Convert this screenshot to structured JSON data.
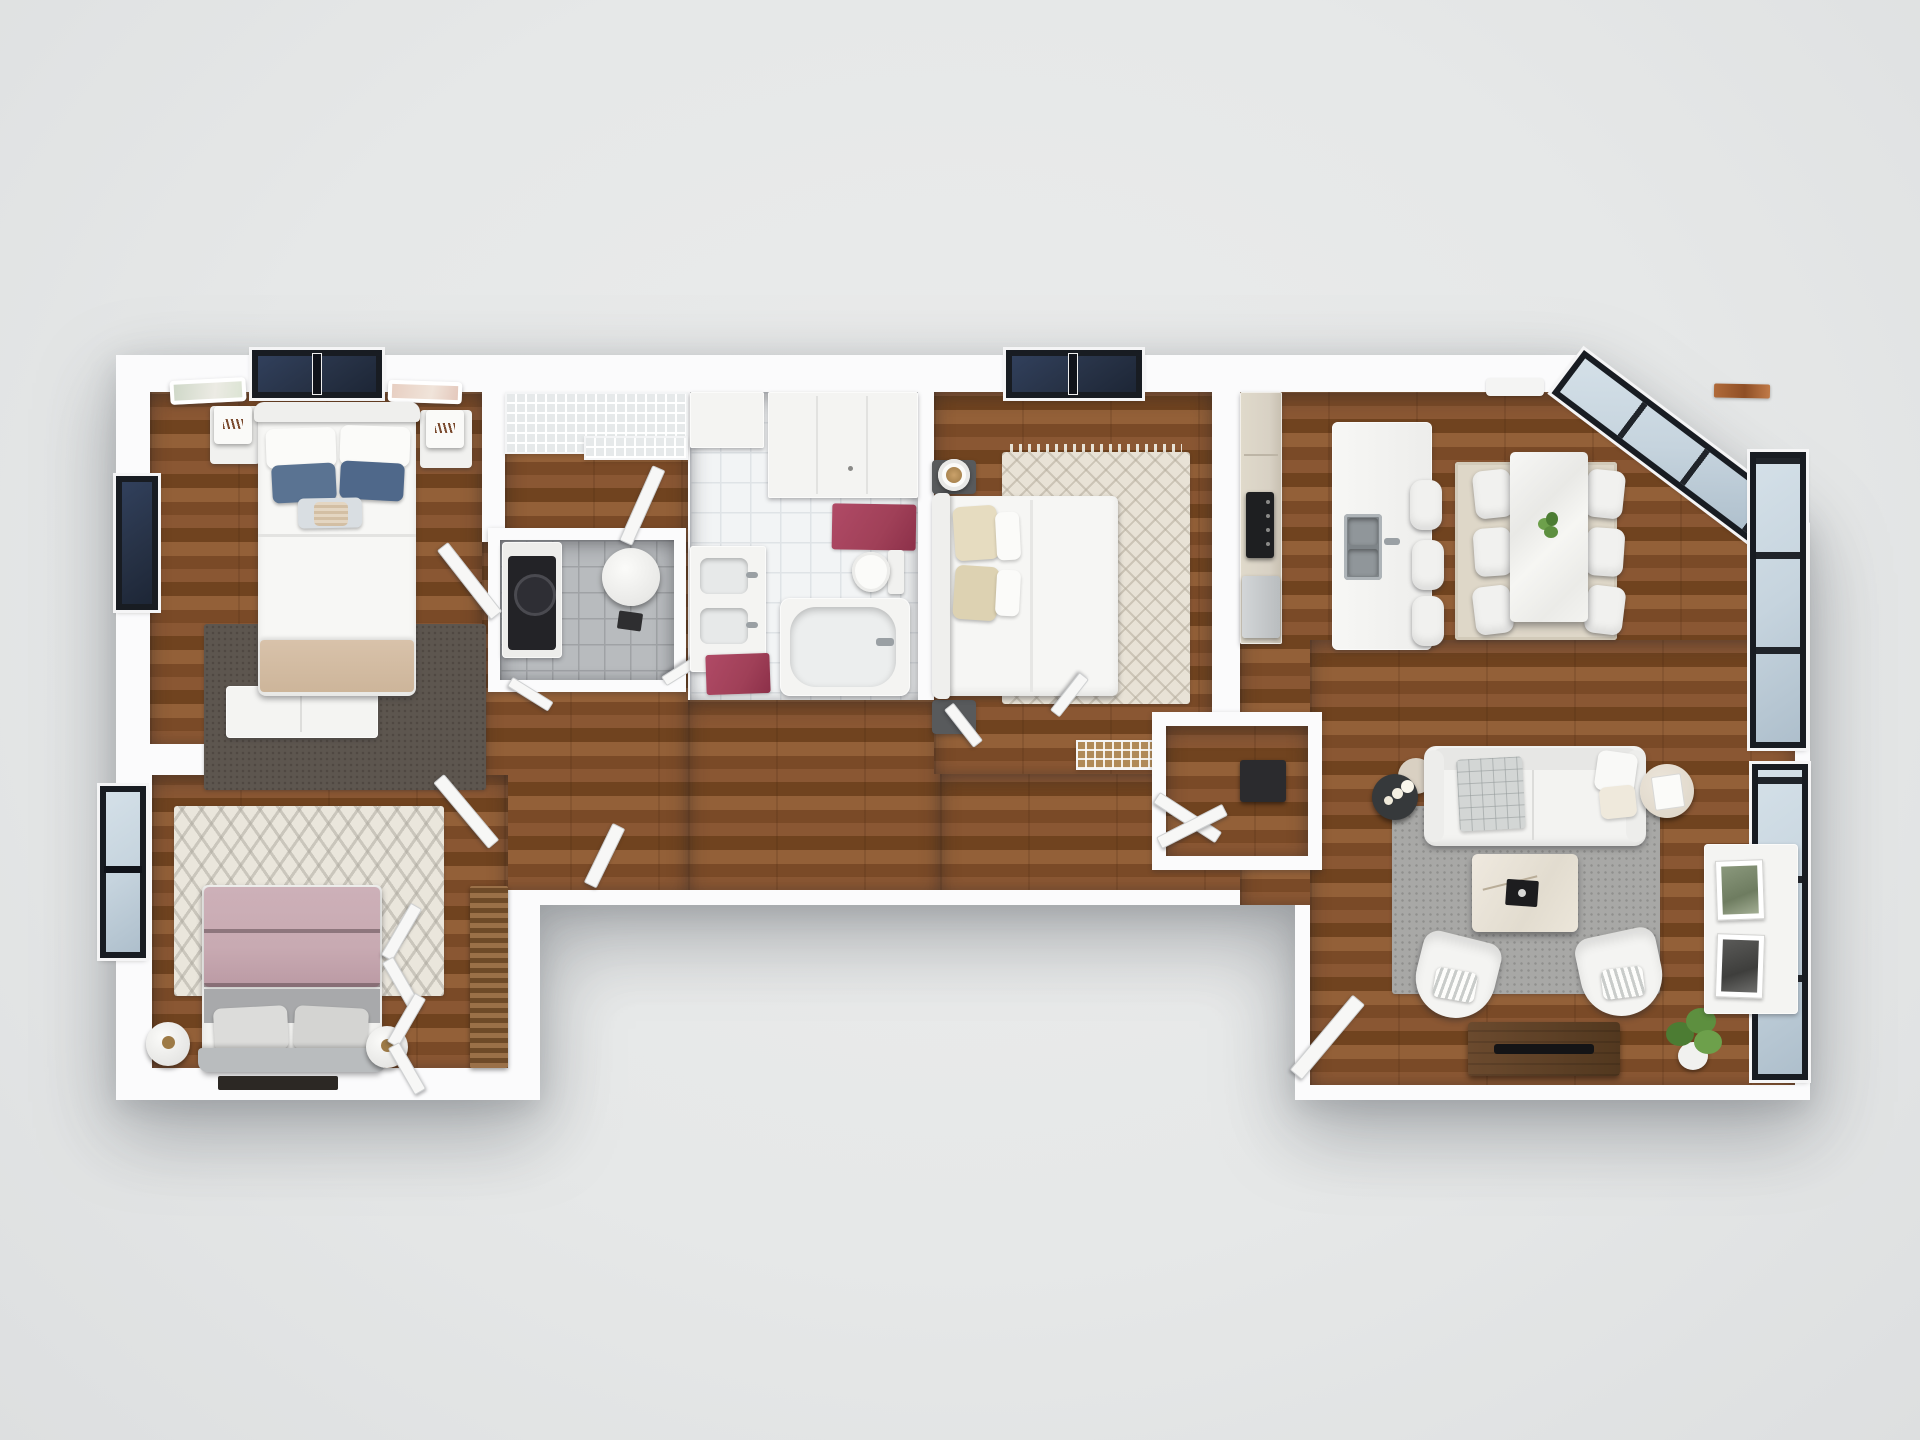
{
  "scene": {
    "kind": "3d-floor-plan-render",
    "view": "top-down",
    "unit": "3-bedroom apartment",
    "visible_text": "none"
  },
  "palette": {
    "bg1": "#ebecec",
    "bg2": "#dddfe0",
    "wall": "#fbfbfc",
    "navy": "#273246",
    "frame": "#181c22",
    "glass": "#c6d4de",
    "maroon": "#a04058",
    "white-f": "#f4f4f2",
    "white-f2": "#ececea",
    "slateblue": "#5a7392",
    "tan": "#d8c2aa",
    "mauve": "#c8aab2",
    "grayduvet": "#a8a9ab",
    "cream": "#e6dcc0",
    "beigerug": "#ded7c8",
    "grayrug": "#a8a8a6",
    "cab": "#d8d1c4",
    "steel": "#9aa0a4",
    "darkwood": "#52381f",
    "plant": "#5d8f3f"
  },
  "rooms": {
    "bedroom_primary": {
      "name": "Primary bedroom (top-left)",
      "floor": "wood",
      "items": [
        "double bed with blue and white pillows",
        "tan foot blanket",
        "two nightstands with lamps",
        "dark textured area rug",
        "white low dresser",
        "two wall art frames",
        "navy top window",
        "navy left window"
      ]
    },
    "walk_in_closet": {
      "name": "Walk-in closet",
      "floor": "wood",
      "items": [
        "white wire shelving"
      ]
    },
    "utility_room": {
      "name": "Utility room",
      "floor": "gray tile",
      "items": [
        "washer with dark door",
        "round water heater",
        "waste bin",
        "double swing doors"
      ]
    },
    "bathroom": {
      "name": "Bathroom",
      "floor": "white tile",
      "items": [
        "tall storage cabinet",
        "vanity with two sinks",
        "toilet",
        "bathtub",
        "two maroon rugs"
      ]
    },
    "bedroom_middle": {
      "name": "Middle bedroom",
      "floor": "wood",
      "items": [
        "bed with cream pillows",
        "diamond-pattern rug with tassels",
        "two dark nightstands",
        "decor plate",
        "wire storage bench",
        "navy top window"
      ]
    },
    "kitchen": {
      "name": "Kitchen",
      "floor": "wood",
      "items": [
        "tall beige cabinets",
        "black cooktop",
        "fridge",
        "island with double steel sink",
        "three bar stools"
      ]
    },
    "dining_area": {
      "name": "Dining area",
      "floor": "wood",
      "items": [
        "marble dining table",
        "six white chairs",
        "beige rug",
        "green centerpiece plant",
        "rust wall decor"
      ]
    },
    "living_room": {
      "name": "Living room",
      "floor": "wood",
      "items": [
        "white sofa",
        "gray throw blanket",
        "black round side table with candles",
        "round side table with book",
        "gray rug",
        "marble coffee table with black book",
        "two tub armchairs",
        "dark wood TV console",
        "potted plant",
        "white wall console with two framed prints",
        "entry door",
        "entry closet"
      ]
    },
    "bedroom_lower": {
      "name": "Lower-left bedroom",
      "floor": "wood",
      "items": [
        "bed with mauve blanket and gray duvet",
        "chevron rug",
        "two round nightstands",
        "wood slat shelving",
        "closet double doors",
        "left window"
      ]
    },
    "hallway": {
      "name": "Hallway",
      "floor": "wood",
      "items": [
        "interior doors"
      ]
    }
  }
}
